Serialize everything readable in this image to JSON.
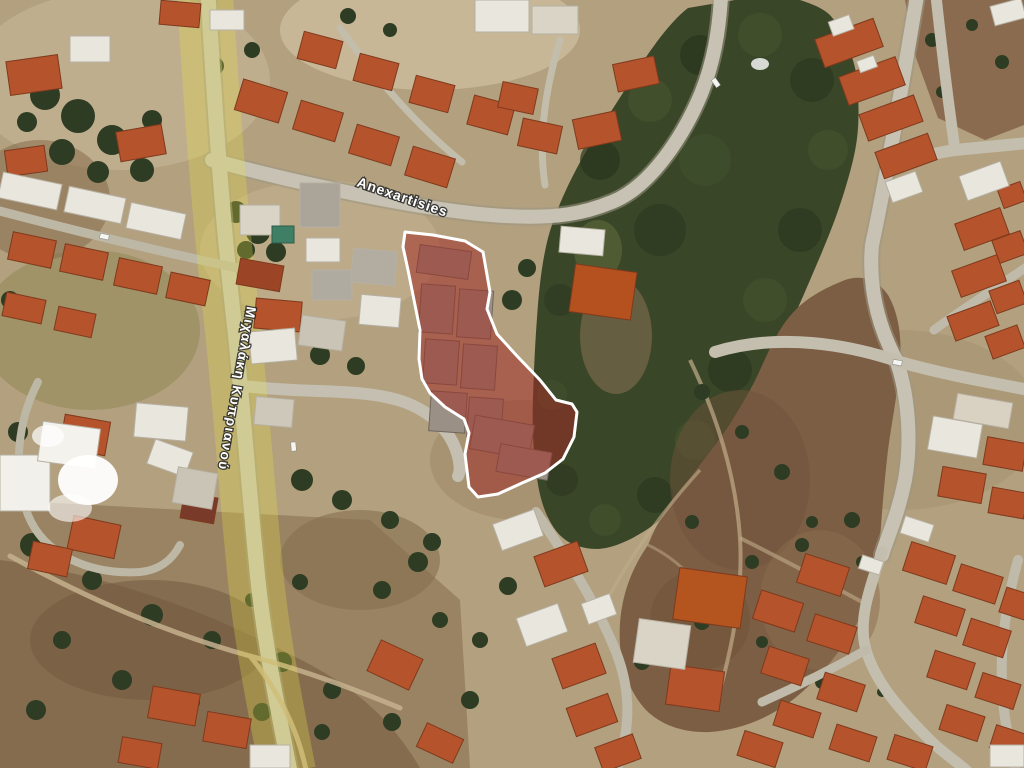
{
  "map": {
    "type": "satellite-imagery",
    "road_labels": [
      {
        "id": "anexartisias",
        "text": "Anexartisies"
      },
      {
        "id": "michalaki-kyprianou",
        "text": "Μιχαλάκη Κυπριανού"
      }
    ],
    "parcel_highlight": {
      "fill_color": "#9e2d26",
      "border_color": "#ffffff"
    },
    "road_highlight": {
      "color": "#e8e245"
    }
  }
}
